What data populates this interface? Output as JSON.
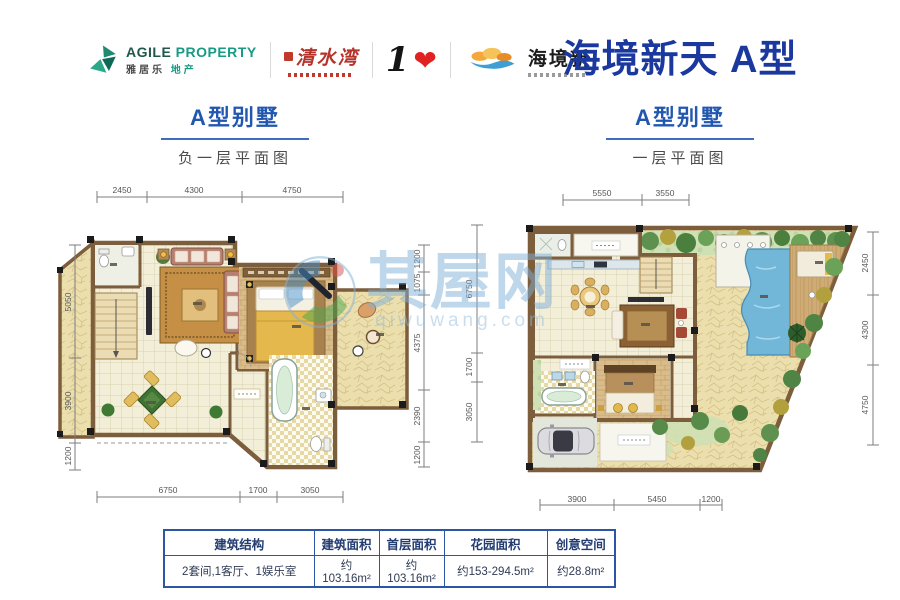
{
  "header": {
    "logos": {
      "agile": {
        "en1": "AGILE",
        "en2": "PROPERTY",
        "cn1": "雅居乐",
        "cn2": "地产"
      },
      "qingshuiwan": {
        "text": "清水湾"
      },
      "one_love": {
        "numeral": "1",
        "heart": "❤"
      },
      "haijingxin": {
        "text": "海境新"
      }
    },
    "title": "海境新天 A型"
  },
  "plans": {
    "left": {
      "heading": "A型别墅",
      "subheading": "负一层平面图",
      "dims": {
        "top": [
          "2450",
          "4300",
          "4750"
        ],
        "left": [
          "5050",
          "3900",
          "1200"
        ],
        "right": [
          "1200",
          "1075",
          "4375",
          "2390",
          "1200"
        ],
        "bottom": [
          "6750",
          "1700",
          "3050"
        ]
      }
    },
    "right": {
      "heading": "A型别墅",
      "subheading": "一层平面图",
      "dims": {
        "top": [
          "5550",
          "3550"
        ],
        "left": [
          "6750",
          "1700",
          "3050"
        ],
        "right": [
          "2450",
          "4300",
          "4750"
        ],
        "bottom": [
          "3900",
          "5450",
          "1200"
        ]
      }
    }
  },
  "watermark": {
    "text": "其屋网",
    "domain": "qiwuwang.com"
  },
  "spec_table": {
    "headers": [
      "建筑结构",
      "建筑面积",
      "首层面积",
      "花园面积",
      "创意空间"
    ],
    "row": [
      "2套间,1客厅、1娱乐室",
      "约103.16m²",
      "约103.16m²",
      "约153-294.5m²",
      "约28.8m²"
    ]
  },
  "colors": {
    "title_blue": "#1a389e",
    "heading_blue": "#2257b0",
    "table_border": "#2d55a6",
    "wall_brown": "#7c5d3c",
    "pool_blue": "#72b6d8"
  }
}
